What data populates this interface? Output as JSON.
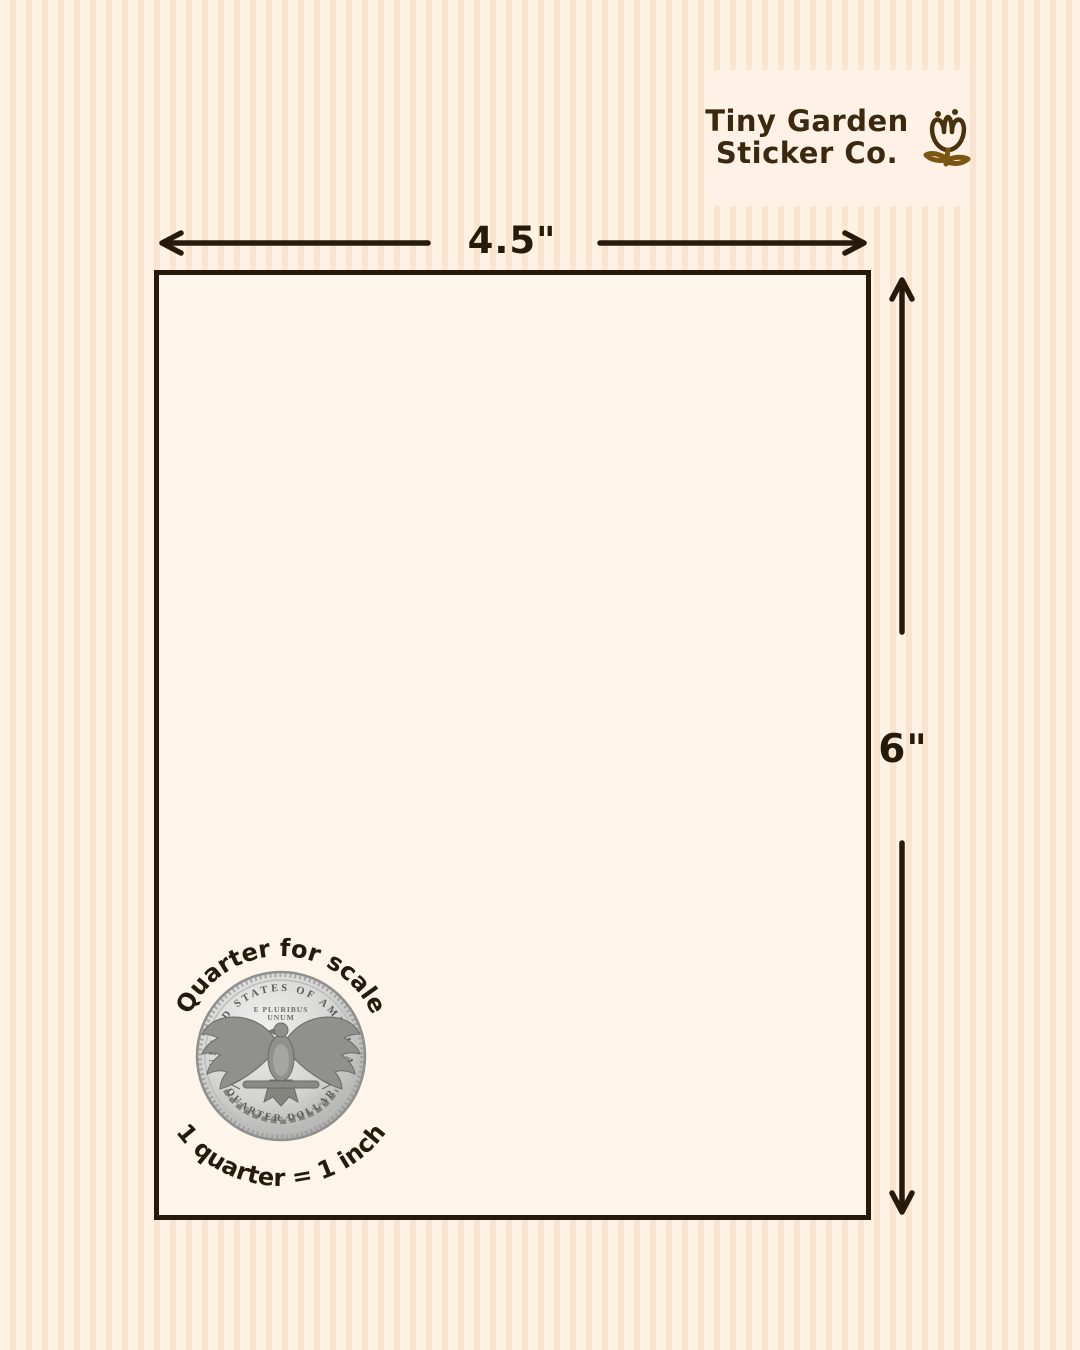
{
  "brand": {
    "name_line1": "Tiny Garden",
    "name_line2": "Sticker Co.",
    "flower_icon": "tulip-flower-icon"
  },
  "dimensions": {
    "width_label": "4.5\"",
    "height_label": "6\""
  },
  "scale_note": {
    "top_caption": "Quarter for scale",
    "bottom_caption": "1 quarter = 1 inch"
  },
  "coin": {
    "legend_top": "UNITED STATES OF AMERICA",
    "motto_line1": "E PLURIBUS",
    "motto_line2": "UNUM",
    "legend_bottom": "QUARTER DOLLAR"
  },
  "colors": {
    "ink": "#261a0b",
    "stripe_light": "#fdf2e3",
    "stripe_dark": "#f9e5cf",
    "sheet_fill": "#fdf5ea",
    "brand_card_fill": "#fdf2e5",
    "brand_text": "#3b280e",
    "flower_gold": "#7c5510",
    "coin_silver": "#c9c9c7"
  }
}
